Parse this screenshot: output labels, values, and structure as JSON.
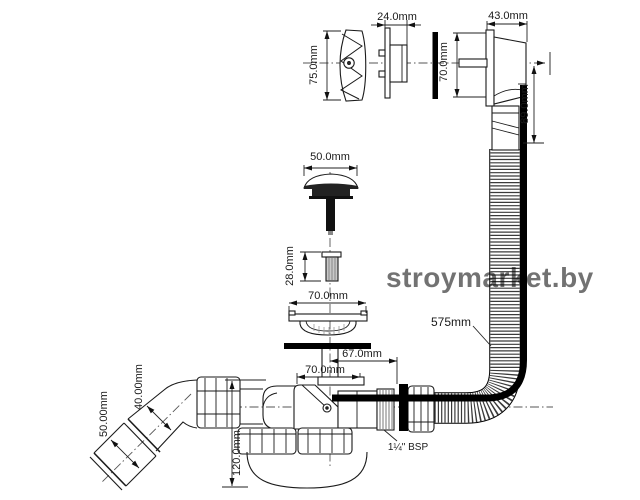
{
  "diagram": {
    "title": "bath waste and overflow kit technical drawing",
    "dims": {
      "cover_height": "75.0mm",
      "rosette_width": "24.0mm",
      "body_width": "43.0mm",
      "body_height": "70.0mm",
      "overflow_drop": "89.0mm",
      "plug_diameter": "50.0mm",
      "insert_height": "28.0mm",
      "flange_diameter": "70.0mm",
      "hose_length": "575mm",
      "waste_offset": "67.0mm",
      "trap_inlet_width": "70.0mm",
      "pipe_diameter": "40.00mm",
      "pipe_end_diameter": "50.00mm",
      "trap_depth": "120.0mm",
      "thread_size": "1¼\" BSP"
    }
  },
  "watermark": {
    "text": "stroymarket.by",
    "color": "#e2949c"
  }
}
